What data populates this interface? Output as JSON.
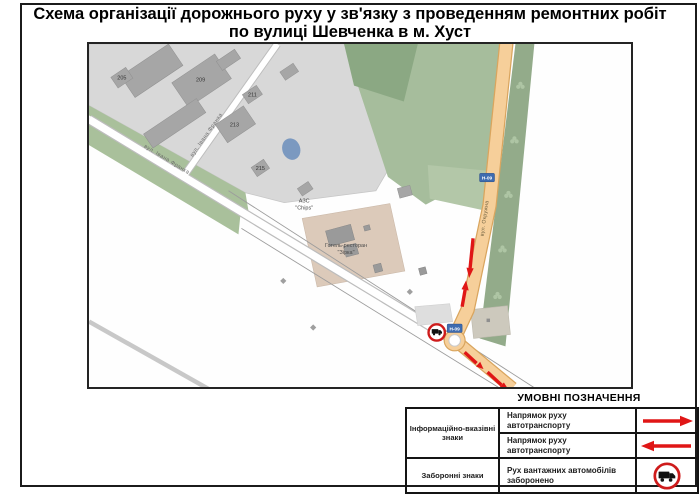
{
  "title": {
    "line1": "Схема організації дорожнього руху у зв'язку з проведенням ремонтних робіт",
    "line2": "по вулиці Шевченка в м. Хуст"
  },
  "map": {
    "streets": {
      "ivana_franka_a": "вул. Івана Франка",
      "ivana_franka_b": "вул. Івана Франка",
      "okruzhna": "вул. Окружна"
    },
    "buildings": {
      "b205": "205",
      "b209": "209",
      "b211": "211",
      "b213": "213",
      "b215": "215"
    },
    "pois": {
      "azs_line1": "АЗС",
      "azs_line2": "\"Chips\"",
      "hotel_line1": "Готель-ресторан",
      "hotel_line2": "\"Зірка\""
    },
    "route_badges": {
      "badge_upper": "Н-09",
      "badge_lower": "Н-09"
    }
  },
  "legend": {
    "title": "УМОВНІ ПОЗНАЧЕННЯ",
    "groups": [
      {
        "label_line1": "Інформаційно-вказівні",
        "label_line2": "знаки"
      },
      {
        "label_line1": "Заборонні знаки",
        "label_line2": ""
      }
    ],
    "rows": [
      {
        "text": "Напрямок руху автотранспорту",
        "icon": "red-arrow-right"
      },
      {
        "text": "Напрямок руху автотранспорту",
        "icon": "red-arrow-left"
      },
      {
        "text_line1": "Рух вантажних автомобілів",
        "text_line2": "заборонено",
        "icon": "no-trucks-sign"
      }
    ]
  },
  "colors": {
    "arrow_red": "#e01616",
    "sign_ring_red": "#ce1b1b",
    "highway_fill": "#f6cf9a",
    "highway_casing": "#d9a55e",
    "route_badge_blue": "#3f6cb0",
    "park_green": "#a6bd9c",
    "tree_strip_green": "#93ab8a",
    "street_strip_green": "#a9c09b",
    "city_block_gray": "#d8d8d8",
    "building_gray": "#a6a6a6",
    "pond_blue": "#7b99c0",
    "hotel_tan": "#dccaba"
  }
}
